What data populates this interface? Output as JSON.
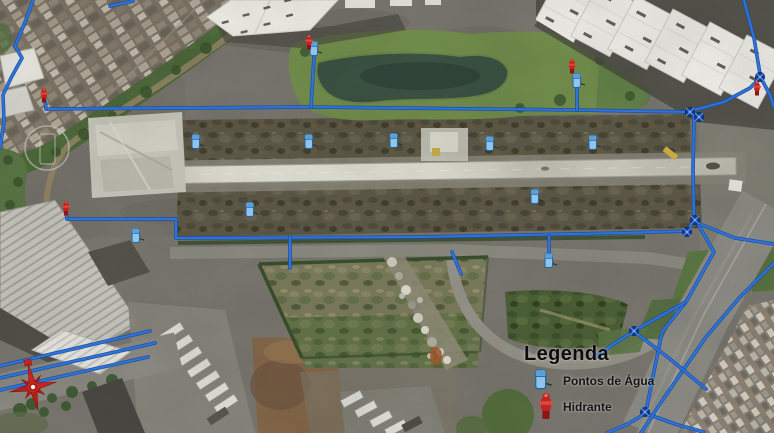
{
  "legend": {
    "title": "Legenda",
    "items": [
      {
        "id": "water-point",
        "label": "Pontos de Água"
      },
      {
        "id": "hydrant",
        "label": "Hidrante"
      }
    ]
  },
  "colors": {
    "pipe": "#2f74d8",
    "pipe_shadow": "#1c4ea6",
    "valve": "#123a8e",
    "hydrant": "#c3241e",
    "water_point": "#8fc4ec",
    "legend_text": "#0c0c0c",
    "compass": "#c5251f"
  },
  "network": {
    "pipes": [
      {
        "name": "main-north",
        "points": [
          [
            46,
            109
          ],
          [
            310,
            107
          ],
          [
            576,
            110
          ],
          [
            690,
            112
          ]
        ]
      },
      {
        "name": "branch-pond",
        "points": [
          [
            311,
            107
          ],
          [
            314,
            57
          ]
        ]
      },
      {
        "name": "branch-east-grass",
        "points": [
          [
            577,
            110
          ],
          [
            577,
            88
          ]
        ]
      },
      {
        "name": "stub-west-hydrant",
        "points": [
          [
            46,
            109
          ],
          [
            45,
            101
          ]
        ]
      },
      {
        "name": "curve-northeast",
        "points": [
          [
            694,
            110
          ],
          [
            724,
            102
          ],
          [
            750,
            88
          ],
          [
            759,
            79
          ]
        ]
      },
      {
        "name": "right-edge-north",
        "points": [
          [
            744,
            0
          ],
          [
            754,
            38
          ],
          [
            760,
            74
          ]
        ]
      },
      {
        "name": "right-edge-exit",
        "points": [
          [
            762,
            80
          ],
          [
            770,
            95
          ],
          [
            774,
            107
          ]
        ]
      },
      {
        "name": "connector-east",
        "points": [
          [
            694,
            116
          ],
          [
            693,
            170
          ],
          [
            694,
            219
          ]
        ]
      },
      {
        "name": "cluster-link",
        "points": [
          [
            694,
            219
          ],
          [
            688,
            231
          ]
        ]
      },
      {
        "name": "main-south",
        "points": [
          [
            67,
            219
          ],
          [
            176,
            219
          ],
          [
            176,
            238
          ],
          [
            420,
            237
          ],
          [
            620,
            233
          ],
          [
            688,
            231
          ]
        ]
      },
      {
        "name": "stub-southwest-hydrant",
        "points": [
          [
            67,
            219
          ],
          [
            66,
            212
          ]
        ]
      },
      {
        "name": "branch-south-1",
        "points": [
          [
            290,
            237
          ],
          [
            290,
            268
          ]
        ]
      },
      {
        "name": "branch-south-2",
        "points": [
          [
            549,
            236
          ],
          [
            549,
            252
          ]
        ]
      },
      {
        "name": "branch-rubble",
        "points": [
          [
            452,
            252
          ],
          [
            461,
            274
          ]
        ]
      },
      {
        "name": "east-exit",
        "points": [
          [
            697,
            223
          ],
          [
            735,
            238
          ],
          [
            774,
            244
          ]
        ]
      },
      {
        "name": "road-pipe-west",
        "points": [
          [
            699,
            226
          ],
          [
            714,
            252
          ],
          [
            686,
            302
          ],
          [
            662,
            332
          ],
          [
            646,
            411
          ]
        ]
      },
      {
        "name": "road-pipe-west-tail",
        "points": [
          [
            646,
            413
          ],
          [
            628,
            424
          ],
          [
            607,
            433
          ]
        ]
      },
      {
        "name": "valve-branch-southeast",
        "points": [
          [
            647,
            414
          ],
          [
            678,
            425
          ],
          [
            704,
            432
          ]
        ]
      },
      {
        "name": "road-pipe-east",
        "points": [
          [
            774,
            263
          ],
          [
            740,
            297
          ],
          [
            706,
            337
          ],
          [
            664,
            398
          ],
          [
            641,
            433
          ]
        ]
      },
      {
        "name": "spur-diagonal",
        "points": [
          [
            635,
            332
          ],
          [
            670,
            359
          ],
          [
            706,
            389
          ]
        ]
      },
      {
        "name": "spur-west",
        "points": [
          [
            684,
            303
          ],
          [
            657,
            318
          ],
          [
            634,
            331
          ],
          [
            612,
            345
          ],
          [
            595,
            358
          ]
        ]
      },
      {
        "name": "favela-edge",
        "points": [
          [
            33,
            0
          ],
          [
            26,
            20
          ],
          [
            15,
            46
          ],
          [
            22,
            58
          ],
          [
            11,
            78
          ],
          [
            3,
            95
          ],
          [
            4,
            122
          ],
          [
            0,
            148
          ]
        ]
      },
      {
        "name": "favela-stub",
        "points": [
          [
            110,
            6
          ],
          [
            133,
            1
          ]
        ]
      },
      {
        "name": "southwest-road-1",
        "points": [
          [
            0,
            366
          ],
          [
            150,
            331
          ]
        ]
      },
      {
        "name": "southwest-road-2",
        "points": [
          [
            0,
            378
          ],
          [
            155,
            343
          ]
        ]
      },
      {
        "name": "southwest-road-3",
        "points": [
          [
            0,
            390
          ],
          [
            148,
            357
          ]
        ]
      }
    ],
    "valves": [
      [
        690,
        112
      ],
      [
        699,
        117
      ],
      [
        695,
        220
      ],
      [
        687,
        232
      ],
      [
        760,
        77
      ],
      [
        645,
        412
      ],
      [
        634,
        331
      ]
    ],
    "hydrants": [
      [
        44,
        97
      ],
      [
        66,
        210
      ],
      [
        309,
        44
      ],
      [
        572,
        68
      ],
      [
        757,
        90
      ]
    ],
    "water_points": [
      [
        314,
        49
      ],
      [
        577,
        81
      ],
      [
        196,
        142
      ],
      [
        309,
        142
      ],
      [
        394,
        141
      ],
      [
        490,
        144
      ],
      [
        593,
        143
      ],
      [
        250,
        210
      ],
      [
        535,
        197
      ],
      [
        136,
        236
      ],
      [
        549,
        261
      ]
    ]
  }
}
